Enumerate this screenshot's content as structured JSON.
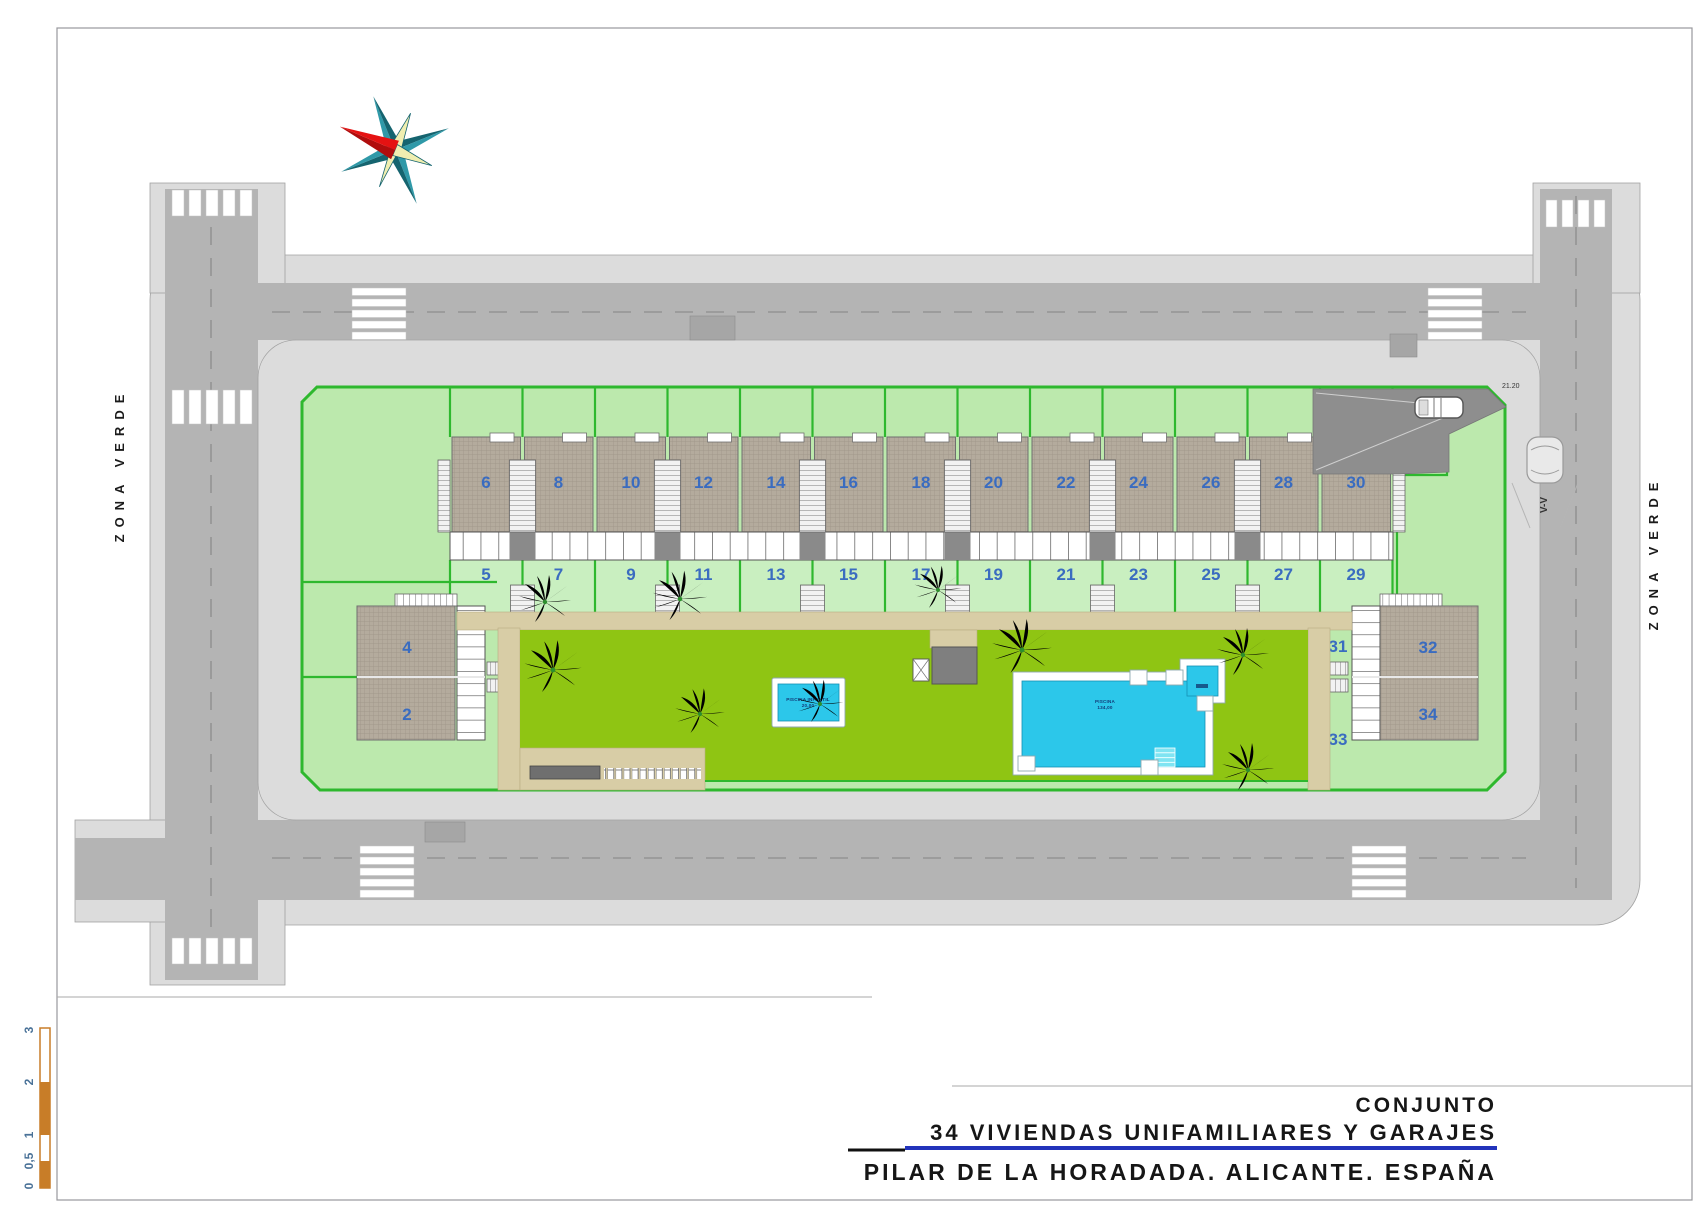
{
  "title_block": {
    "line1": "CONJUNTO",
    "line2": "34 VIVIENDAS UNIFAMILIARES Y GARAJES",
    "line3": "PILAR DE LA HORADADA. ALICANTE. ESPAÑA"
  },
  "labels": {
    "zona_verde": "ZONA VERDE",
    "parking_section": "V-V",
    "driveway_dim": "21.20"
  },
  "scale_bar": {
    "ticks": [
      "3",
      "2",
      "1",
      "0,5",
      "0"
    ]
  },
  "pools": {
    "kids": {
      "label": "PISCINA INFANTIL",
      "area": "20,00"
    },
    "main": {
      "label": "PISCINA",
      "area": "134,00"
    }
  },
  "plot": {
    "house_units": [
      {
        "upper": "6",
        "lower": "5"
      },
      {
        "upper": "8",
        "lower": "7"
      },
      {
        "upper": "10",
        "lower": "9"
      },
      {
        "upper": "12",
        "lower": "11"
      },
      {
        "upper": "14",
        "lower": "13"
      },
      {
        "upper": "16",
        "lower": "15"
      },
      {
        "upper": "18",
        "lower": "17"
      },
      {
        "upper": "20",
        "lower": "19"
      },
      {
        "upper": "22",
        "lower": "21"
      },
      {
        "upper": "24",
        "lower": "23"
      },
      {
        "upper": "26",
        "lower": "25"
      },
      {
        "upper": "28",
        "lower": "27"
      },
      {
        "upper": "30",
        "lower": "29"
      }
    ],
    "left_building": {
      "upper": "4",
      "lower": "2",
      "garden_upper": "3",
      "garden_lower": "1"
    },
    "right_building": {
      "upper": "32",
      "lower": "34",
      "garden_upper": "31",
      "garden_lower": "33"
    }
  },
  "colors": {
    "plot_green": "#bce9ad",
    "boundary_green": "#2eb82e",
    "garden_green": "#8fc513",
    "pool_water": "#2cc7ea",
    "asphalt": "#b4b4b4",
    "sidewalk": "#dcdcdc",
    "roof_gray": "#b4ab9d",
    "path_tan": "#d8cda6",
    "number_blue": "#3a6cc0",
    "scale_orange": "#c87d28",
    "title_accent": "#2233bb",
    "compass_red": "#e51212",
    "compass_teal": "#1d7f8e"
  }
}
